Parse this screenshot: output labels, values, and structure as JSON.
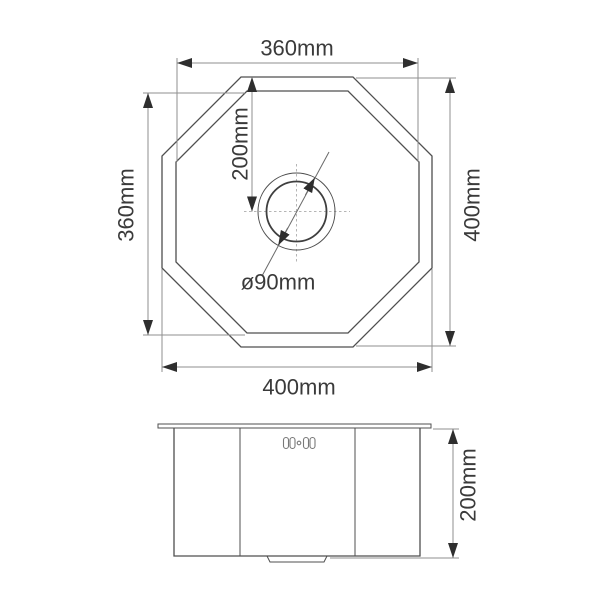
{
  "drawing": {
    "type": "sink-technical-drawing",
    "top_view": {
      "width_inner_label": "360mm",
      "height_inner_label": "360mm",
      "height_outer_label": "400mm",
      "width_outer_label": "400mm",
      "drain_offset_label": "200mm",
      "drain_diameter_label": "ø90mm"
    },
    "side_view": {
      "depth_label": "200mm"
    },
    "colors": {
      "background": "#ffffff",
      "outline": "#4f4f4f",
      "dimension_line": "#8f8f8f",
      "arrowhead": "#2e2e2e",
      "text": "#3a3a3a",
      "centerline": "#b5b5b5",
      "emblem": "#787878"
    }
  }
}
